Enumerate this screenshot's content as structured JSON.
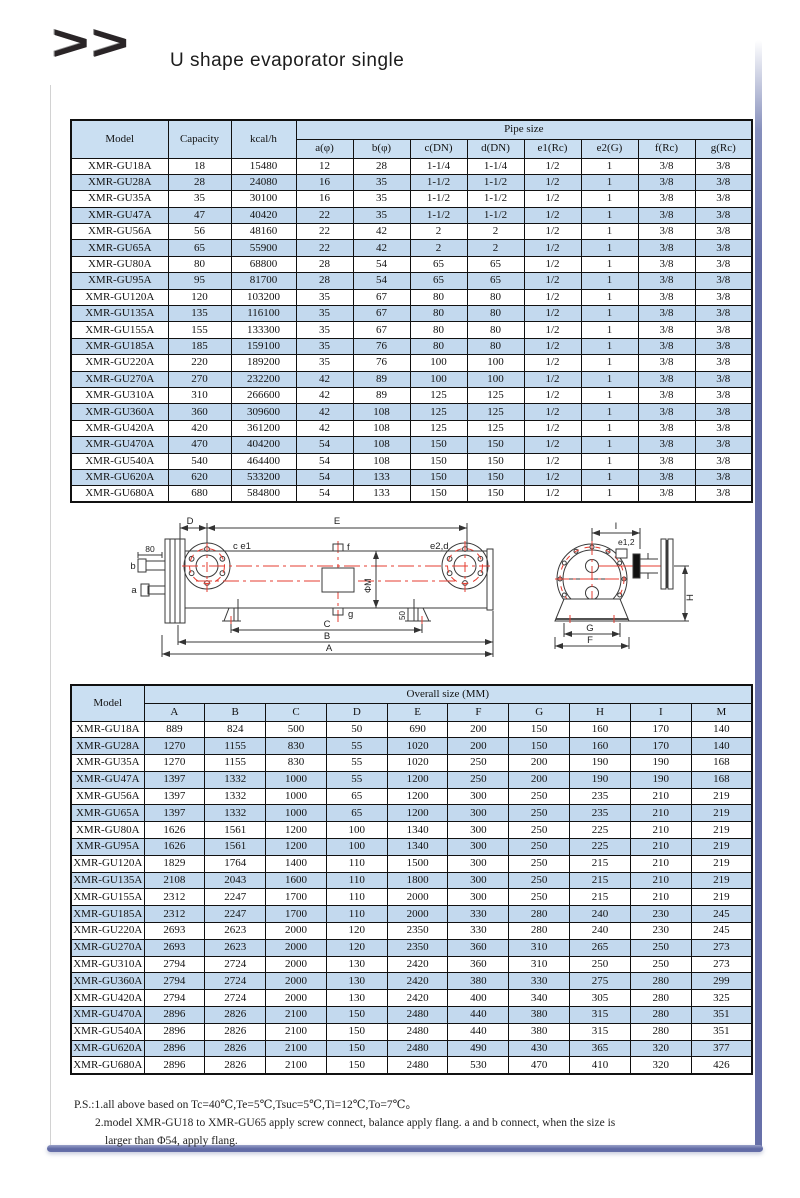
{
  "header": {
    "logo": ">>",
    "title": "U shape evaporator single"
  },
  "pipe_table": {
    "col_model": "Model",
    "col_capacity": "Capacity",
    "col_kcal": "kcal/h",
    "group_header": "Pipe size",
    "sub_columns": [
      "a(φ)",
      "b(φ)",
      "c(DN)",
      "d(DN)",
      "e1(Rc)",
      "e2(G)",
      "f(Rc)",
      "g(Rc)"
    ],
    "rows": [
      [
        "XMR-GU18A",
        "18",
        "15480",
        "12",
        "28",
        "1-1/4",
        "1-1/4",
        "1/2",
        "1",
        "3/8",
        "3/8"
      ],
      [
        "XMR-GU28A",
        "28",
        "24080",
        "16",
        "35",
        "1-1/2",
        "1-1/2",
        "1/2",
        "1",
        "3/8",
        "3/8"
      ],
      [
        "XMR-GU35A",
        "35",
        "30100",
        "16",
        "35",
        "1-1/2",
        "1-1/2",
        "1/2",
        "1",
        "3/8",
        "3/8"
      ],
      [
        "XMR-GU47A",
        "47",
        "40420",
        "22",
        "35",
        "1-1/2",
        "1-1/2",
        "1/2",
        "1",
        "3/8",
        "3/8"
      ],
      [
        "XMR-GU56A",
        "56",
        "48160",
        "22",
        "42",
        "2",
        "2",
        "1/2",
        "1",
        "3/8",
        "3/8"
      ],
      [
        "XMR-GU65A",
        "65",
        "55900",
        "22",
        "42",
        "2",
        "2",
        "1/2",
        "1",
        "3/8",
        "3/8"
      ],
      [
        "XMR-GU80A",
        "80",
        "68800",
        "28",
        "54",
        "65",
        "65",
        "1/2",
        "1",
        "3/8",
        "3/8"
      ],
      [
        "XMR-GU95A",
        "95",
        "81700",
        "28",
        "54",
        "65",
        "65",
        "1/2",
        "1",
        "3/8",
        "3/8"
      ],
      [
        "XMR-GU120A",
        "120",
        "103200",
        "35",
        "67",
        "80",
        "80",
        "1/2",
        "1",
        "3/8",
        "3/8"
      ],
      [
        "XMR-GU135A",
        "135",
        "116100",
        "35",
        "67",
        "80",
        "80",
        "1/2",
        "1",
        "3/8",
        "3/8"
      ],
      [
        "XMR-GU155A",
        "155",
        "133300",
        "35",
        "67",
        "80",
        "80",
        "1/2",
        "1",
        "3/8",
        "3/8"
      ],
      [
        "XMR-GU185A",
        "185",
        "159100",
        "35",
        "76",
        "80",
        "80",
        "1/2",
        "1",
        "3/8",
        "3/8"
      ],
      [
        "XMR-GU220A",
        "220",
        "189200",
        "35",
        "76",
        "100",
        "100",
        "1/2",
        "1",
        "3/8",
        "3/8"
      ],
      [
        "XMR-GU270A",
        "270",
        "232200",
        "42",
        "89",
        "100",
        "100",
        "1/2",
        "1",
        "3/8",
        "3/8"
      ],
      [
        "XMR-GU310A",
        "310",
        "266600",
        "42",
        "89",
        "125",
        "125",
        "1/2",
        "1",
        "3/8",
        "3/8"
      ],
      [
        "XMR-GU360A",
        "360",
        "309600",
        "42",
        "108",
        "125",
        "125",
        "1/2",
        "1",
        "3/8",
        "3/8"
      ],
      [
        "XMR-GU420A",
        "420",
        "361200",
        "42",
        "108",
        "125",
        "125",
        "1/2",
        "1",
        "3/8",
        "3/8"
      ],
      [
        "XMR-GU470A",
        "470",
        "404200",
        "54",
        "108",
        "150",
        "150",
        "1/2",
        "1",
        "3/8",
        "3/8"
      ],
      [
        "XMR-GU540A",
        "540",
        "464400",
        "54",
        "108",
        "150",
        "150",
        "1/2",
        "1",
        "3/8",
        "3/8"
      ],
      [
        "XMR-GU620A",
        "620",
        "533200",
        "54",
        "133",
        "150",
        "150",
        "1/2",
        "1",
        "3/8",
        "3/8"
      ],
      [
        "XMR-GU680A",
        "680",
        "584800",
        "54",
        "133",
        "150",
        "150",
        "1/2",
        "1",
        "3/8",
        "3/8"
      ]
    ]
  },
  "diagram": {
    "labels": {
      "dim_D": "D",
      "dim_E": "E",
      "dim_80": "80",
      "port_b": "b",
      "port_a": "a",
      "label_ce1": "c e1",
      "port_f": "f",
      "label_e2d": "e2,d",
      "dim_phiM": "ΦM",
      "port_g": "g",
      "dim_50": "50",
      "dim_C": "C",
      "dim_B": "B",
      "dim_A": "A",
      "dim_I": "I",
      "label_e12": "e1,2",
      "dim_H": "H",
      "dim_G": "G",
      "dim_F": "F"
    }
  },
  "overall_table": {
    "col_model": "Model",
    "group_header": "Overall size (MM)",
    "sub_columns": [
      "A",
      "B",
      "C",
      "D",
      "E",
      "F",
      "G",
      "H",
      "I",
      "M"
    ],
    "rows": [
      [
        "XMR-GU18A",
        "889",
        "824",
        "500",
        "50",
        "690",
        "200",
        "150",
        "160",
        "170",
        "140"
      ],
      [
        "XMR-GU28A",
        "1270",
        "1155",
        "830",
        "55",
        "1020",
        "200",
        "150",
        "160",
        "170",
        "140"
      ],
      [
        "XMR-GU35A",
        "1270",
        "1155",
        "830",
        "55",
        "1020",
        "250",
        "200",
        "190",
        "190",
        "168"
      ],
      [
        "XMR-GU47A",
        "1397",
        "1332",
        "1000",
        "55",
        "1200",
        "250",
        "200",
        "190",
        "190",
        "168"
      ],
      [
        "XMR-GU56A",
        "1397",
        "1332",
        "1000",
        "65",
        "1200",
        "300",
        "250",
        "235",
        "210",
        "219"
      ],
      [
        "XMR-GU65A",
        "1397",
        "1332",
        "1000",
        "65",
        "1200",
        "300",
        "250",
        "235",
        "210",
        "219"
      ],
      [
        "XMR-GU80A",
        "1626",
        "1561",
        "1200",
        "100",
        "1340",
        "300",
        "250",
        "225",
        "210",
        "219"
      ],
      [
        "XMR-GU95A",
        "1626",
        "1561",
        "1200",
        "100",
        "1340",
        "300",
        "250",
        "225",
        "210",
        "219"
      ],
      [
        "XMR-GU120A",
        "1829",
        "1764",
        "1400",
        "110",
        "1500",
        "300",
        "250",
        "215",
        "210",
        "219"
      ],
      [
        "XMR-GU135A",
        "2108",
        "2043",
        "1600",
        "110",
        "1800",
        "300",
        "250",
        "215",
        "210",
        "219"
      ],
      [
        "XMR-GU155A",
        "2312",
        "2247",
        "1700",
        "110",
        "2000",
        "300",
        "250",
        "215",
        "210",
        "219"
      ],
      [
        "XMR-GU185A",
        "2312",
        "2247",
        "1700",
        "110",
        "2000",
        "330",
        "280",
        "240",
        "230",
        "245"
      ],
      [
        "XMR-GU220A",
        "2693",
        "2623",
        "2000",
        "120",
        "2350",
        "330",
        "280",
        "240",
        "230",
        "245"
      ],
      [
        "XMR-GU270A",
        "2693",
        "2623",
        "2000",
        "120",
        "2350",
        "360",
        "310",
        "265",
        "250",
        "273"
      ],
      [
        "XMR-GU310A",
        "2794",
        "2724",
        "2000",
        "130",
        "2420",
        "360",
        "310",
        "250",
        "250",
        "273"
      ],
      [
        "XMR-GU360A",
        "2794",
        "2724",
        "2000",
        "130",
        "2420",
        "380",
        "330",
        "275",
        "280",
        "299"
      ],
      [
        "XMR-GU420A",
        "2794",
        "2724",
        "2000",
        "130",
        "2420",
        "400",
        "340",
        "305",
        "280",
        "325"
      ],
      [
        "XMR-GU470A",
        "2896",
        "2826",
        "2100",
        "150",
        "2480",
        "440",
        "380",
        "315",
        "280",
        "351"
      ],
      [
        "XMR-GU540A",
        "2896",
        "2826",
        "2100",
        "150",
        "2480",
        "440",
        "380",
        "315",
        "280",
        "351"
      ],
      [
        "XMR-GU620A",
        "2896",
        "2826",
        "2100",
        "150",
        "2480",
        "490",
        "430",
        "365",
        "320",
        "377"
      ],
      [
        "XMR-GU680A",
        "2896",
        "2826",
        "2100",
        "150",
        "2480",
        "530",
        "470",
        "410",
        "320",
        "426"
      ]
    ]
  },
  "notes": {
    "line1": "P.S.:1.all above based on Tc=40℃,Te=5℃,Tsuc=5℃,Ti=12℃,To=7℃。",
    "line2": "2.model XMR-GU18 to XMR-GU65 apply screw connect, balance apply flang. a and b connect, when the size is",
    "line3": "larger than Φ54, apply flang."
  }
}
